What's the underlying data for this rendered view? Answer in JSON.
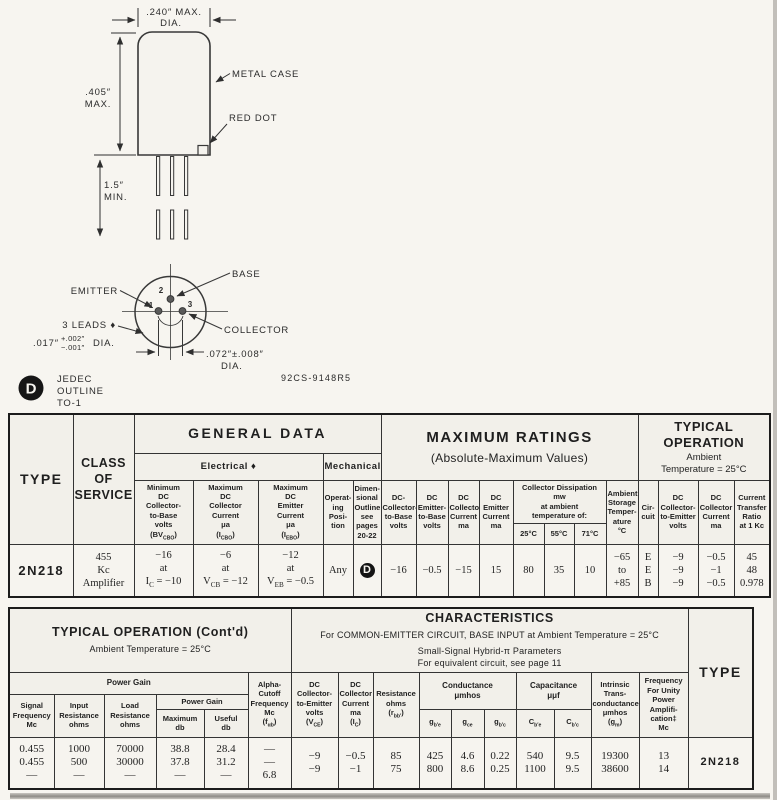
{
  "diagram": {
    "dia_max": ".240″ MAX.",
    "dia_max_2": "DIA.",
    "metal_case": "METAL CASE",
    "red_dot": "RED DOT",
    "height": ".405″",
    "height_2": "MAX.",
    "lead_min": "1.5″",
    "lead_min_2": "MIN.",
    "base": "BASE",
    "emitter": "EMITTER",
    "collector": "COLLECTOR",
    "pin1": "1",
    "pin2": "2",
    "pin3": "3",
    "leads": "3 LEADS ♦",
    "leads_dia": ".017″",
    "leads_dia_plus": "+.002″",
    "leads_dia_minus": "−.001″",
    "leads_dia_unit": "DIA.",
    "pin_spacing": ".072″±.008″",
    "pin_spacing_2": "DIA.",
    "drawing_number": "92CS-9148R5",
    "jedec_badge": "D",
    "jedec_1": "JEDEC",
    "jedec_2": "OUTLINE",
    "jedec_3": "TO-1"
  },
  "t1": {
    "h": {
      "type": "TYPE",
      "class_of_service": [
        "CLASS",
        "OF",
        "SERVICE"
      ],
      "general_data": "GENERAL DATA",
      "electrical": "Electrical ♦",
      "mechanical": "Mechanical",
      "maximum_ratings": "MAXIMUM RATINGS",
      "maximum_ratings_sub": "(Absolute-Maximum Values)",
      "typical_operation": [
        "TYPICAL",
        "OPERATION"
      ],
      "typical_operation_sub": [
        "Ambient",
        "Temperature = 25°C"
      ],
      "min_cb_volts": [
        "Minimum",
        "DC",
        "Collector-",
        "to-Base",
        "volts",
        "(BV~CBO~)"
      ],
      "max_collector_current": [
        "Maximum",
        "DC",
        "Collector",
        "Current",
        "μa",
        "(I~CBO~)"
      ],
      "max_emitter_current": [
        "Maximum",
        "DC",
        "Emitter",
        "Current",
        "μa",
        "(I~EBO~)"
      ],
      "operating_position": [
        "Operat-",
        "ing",
        "Posi-",
        "tion"
      ],
      "dimensional_outline": [
        "Dimen-",
        "sional",
        "Outline",
        "see pages",
        "20-22"
      ],
      "dc_cb_volts": [
        "DC-",
        "Collector-",
        "to-Base",
        "volts"
      ],
      "dc_eb_volts": [
        "DC",
        "Emitter-",
        "to-Base",
        "volts"
      ],
      "dc_collector_current": [
        "DC",
        "Collector",
        "Current",
        "ma"
      ],
      "dc_emitter_current": [
        "DC",
        "Emitter",
        "Current",
        "ma"
      ],
      "collector_dissipation": [
        "Collector Dissipation",
        "mw",
        "at ambient",
        "temperature of:"
      ],
      "t25": "25°C",
      "t55": "55°C",
      "t71": "71°C",
      "storage_temp": [
        "Ambient",
        "Storage",
        "Temper-",
        "ature",
        "°C"
      ],
      "circuit": [
        "Cir-",
        "cuit"
      ],
      "dc_ce_volts": [
        "DC",
        "Collector-",
        "to-Emitter",
        "volts"
      ],
      "dc_collector_current2": [
        "DC",
        "Collector",
        "Current",
        "ma"
      ],
      "transfer_ratio": [
        "Current",
        "Transfer",
        "Ratio",
        "at 1 Kc"
      ]
    },
    "row": {
      "type": "2N218",
      "class_of_service": [
        "455",
        "Kc",
        "Amplifier"
      ],
      "min_cb_volts": [
        "−16",
        "at",
        "I~C~ = −10"
      ],
      "max_collector_current": [
        "−6",
        "at",
        "V~CB~ = −12"
      ],
      "max_emitter_current": [
        "−12",
        "at",
        "V~EB~ = −0.5"
      ],
      "operating_position": "Any",
      "dimensional_outline": "D",
      "dc_cb_volts": "−16",
      "dc_eb_volts": "−0.5",
      "dc_collector_current": "−15",
      "dc_emitter_current": "15",
      "diss_25": "80",
      "diss_55": "35",
      "diss_71": "10",
      "storage_temp": [
        "−65",
        "to",
        "+85"
      ],
      "circuit": [
        "E",
        "E",
        "B"
      ],
      "dc_ce_volts": [
        "−9",
        "−9",
        "−9"
      ],
      "dc_collector_current2": [
        "−0.5",
        "−1",
        "−0.5"
      ],
      "transfer_ratio": [
        "45",
        "48",
        "0.978"
      ]
    }
  },
  "t2": {
    "h": {
      "typical_operation": "TYPICAL OPERATION (Cont'd)",
      "typical_operation_sub": "Ambient Temperature = 25°C",
      "characteristics": "CHARACTERISTICS",
      "characteristics_sub1": "For COMMON-EMITTER CIRCUIT, BASE INPUT at Ambient Temperature = 25°C",
      "characteristics_sub2": "Small-Signal Hybrid-π Parameters",
      "characteristics_sub3": "For equivalent circuit, see page 11",
      "power_gain_group": "Power Gain",
      "signal_frequency": [
        "Signal",
        "Frequency",
        "Mc"
      ],
      "input_resistance": [
        "Input",
        "Resistance",
        "ohms"
      ],
      "load_resistance": [
        "Load",
        "Resistance",
        "ohms"
      ],
      "power_gain_sub": "Power Gain",
      "maximum_db": [
        "Maximum",
        "db"
      ],
      "useful_db": [
        "Useful",
        "db"
      ],
      "alpha_cutoff": [
        "Alpha-",
        "Cutoff",
        "Frequency",
        "Mc",
        "(f~αb~)"
      ],
      "dc_ce_volts": [
        "DC",
        "Collector-",
        "to-Emitter",
        "volts",
        "(V~CE~)"
      ],
      "dc_collector_current": [
        "DC",
        "Collector",
        "Current",
        "ma",
        "(I~C~)"
      ],
      "resistance": [
        "Resistance",
        "ohms",
        "(r~bb′~)"
      ],
      "conductance_group": [
        "Conductance",
        "μmhos"
      ],
      "g_bpe": "g~b′e~",
      "g_ce": "g~ce~",
      "g_bpc": "g~b′c~",
      "capacitance_group": [
        "Capacitance",
        "μμf"
      ],
      "c_bpe": "C~b′e~",
      "c_bpc": "C~b′c~",
      "intrinsic": [
        "Intrinsic",
        "Trans-",
        "conductance",
        "μmhos",
        "(g~m~)"
      ],
      "unity_freq": [
        "Frequency",
        "For Unity",
        "Power",
        "Amplifi-",
        "cation‡",
        "Mc"
      ],
      "type": "TYPE"
    },
    "row": {
      "signal_frequency": [
        "0.455",
        "0.455",
        "—"
      ],
      "input_resistance": [
        "1000",
        "500",
        "—"
      ],
      "load_resistance": [
        "70000",
        "30000",
        "—"
      ],
      "maximum_db": [
        "38.8",
        "37.8",
        "—"
      ],
      "useful_db": [
        "28.4",
        "31.2",
        "—"
      ],
      "alpha_cutoff": [
        "—",
        "—",
        "6.8"
      ],
      "dc_ce_volts": [
        "−9",
        "−9"
      ],
      "dc_collector_current": [
        "−0.5",
        "−1"
      ],
      "resistance": [
        "85",
        "75"
      ],
      "g_bpe": [
        "425",
        "800"
      ],
      "g_ce": [
        "4.6",
        "8.6"
      ],
      "g_bpc": [
        "0.22",
        "0.25"
      ],
      "c_bpe": [
        "540",
        "1100"
      ],
      "c_bpc": [
        "9.5",
        "9.5"
      ],
      "intrinsic": [
        "19300",
        "38600"
      ],
      "unity_freq": [
        "13",
        "14"
      ],
      "type": "2N218"
    }
  }
}
